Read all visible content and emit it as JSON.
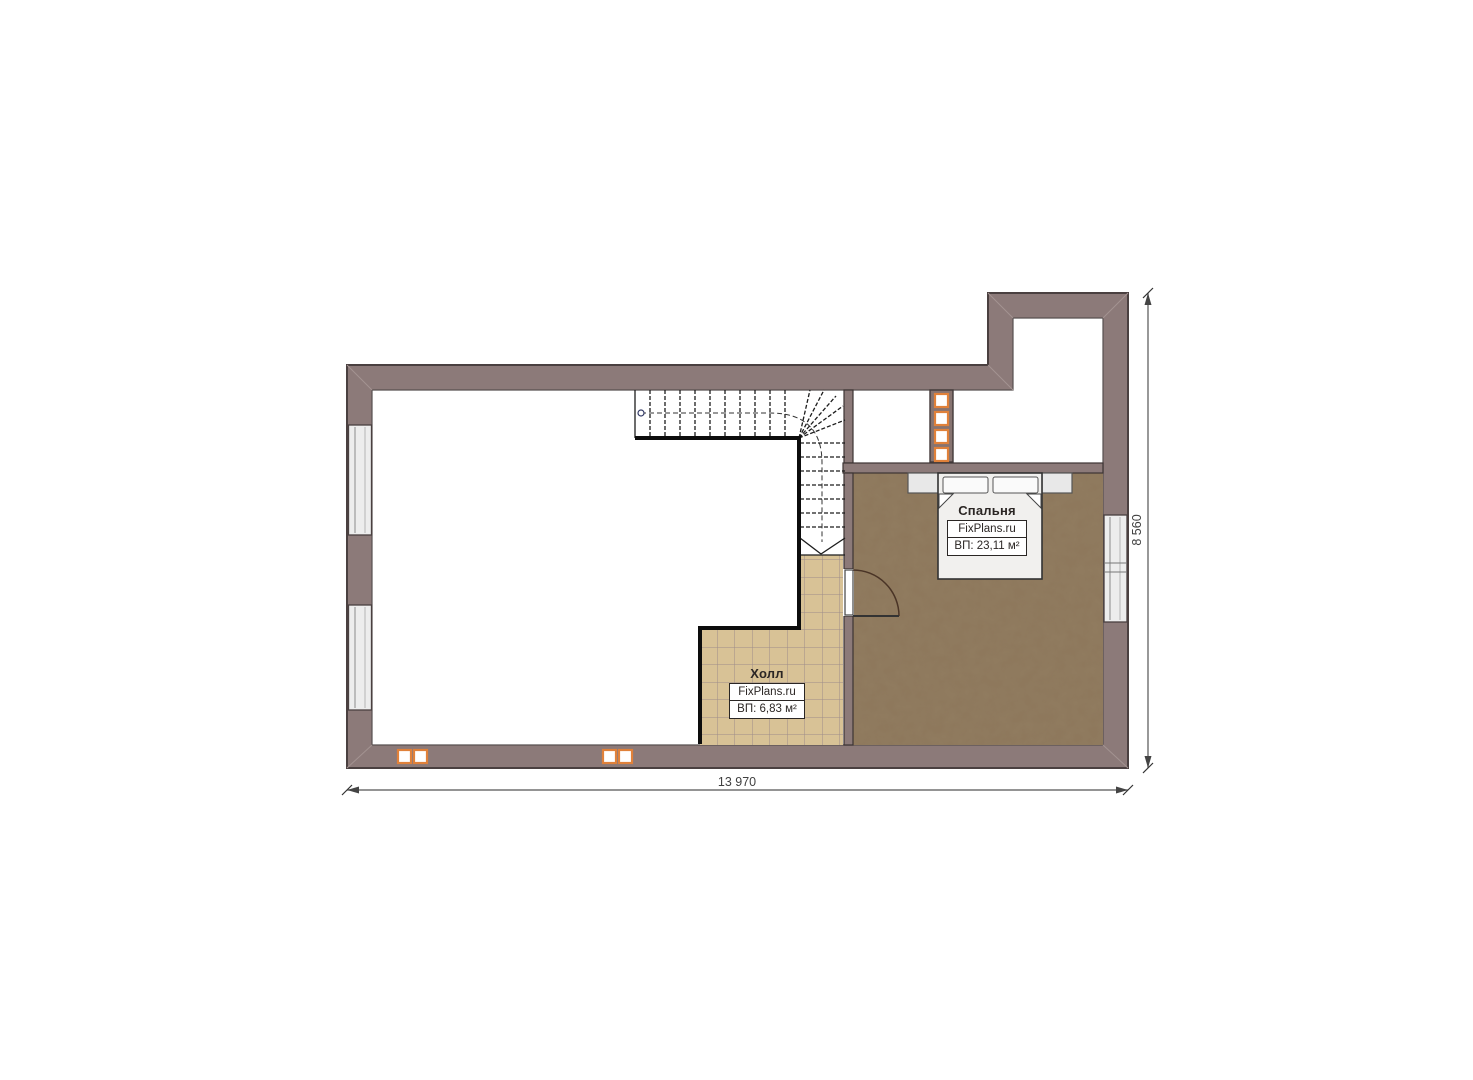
{
  "plan": {
    "type": "floor-plan",
    "rooms": [
      {
        "name": "Спальня",
        "watermark": "FixPlans.ru",
        "area_label": "ВП: 23,11 м²"
      },
      {
        "name": "Холл",
        "watermark": "FixPlans.ru",
        "area_label": "ВП: 6,83 м²"
      }
    ],
    "dimensions": {
      "width_label": "13 970",
      "height_label": "8 560"
    },
    "colors": {
      "wall_fill": "#8c7a79",
      "wall_outline": "#4a4040",
      "tile_floor": "#d8c296",
      "tile_grid": "#9e8c8a",
      "carpet_floor": "#8d775b",
      "vent_accent": "#e0813a",
      "window_fill": "#ededed",
      "stair_line": "#1c1c1c",
      "dimension_line": "#555555"
    }
  }
}
